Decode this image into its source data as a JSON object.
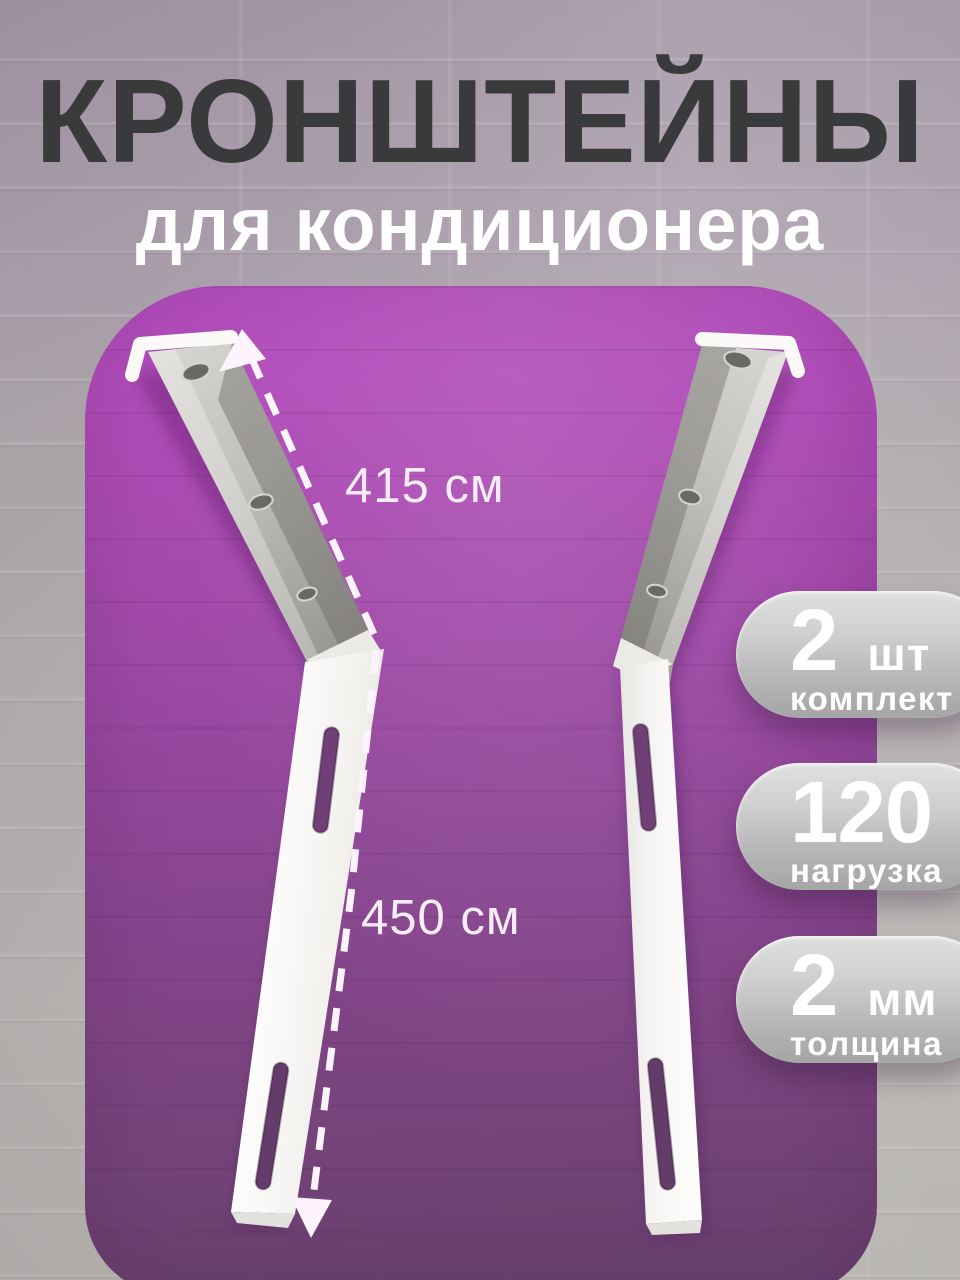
{
  "title": {
    "main": "КРОНШТЕЙНЫ",
    "sub": "для кондиционера"
  },
  "measurements": {
    "upper_label": "415 см",
    "lower_label": "450 см"
  },
  "badges": [
    {
      "value": "2",
      "unit": "шт",
      "label": "комплект"
    },
    {
      "value": "120",
      "unit": "кг",
      "label": "нагрузка"
    },
    {
      "value": "2",
      "unit": "мм",
      "label": "толщина"
    }
  ],
  "colors": {
    "panel_purple_top": "#b44ebd",
    "panel_purple_bottom": "#6b4170",
    "badge_gray": "#bdbdbd",
    "title_dark": "#3a393b",
    "text_white": "#ffffff",
    "wall_gray": "#b4b0b0"
  }
}
